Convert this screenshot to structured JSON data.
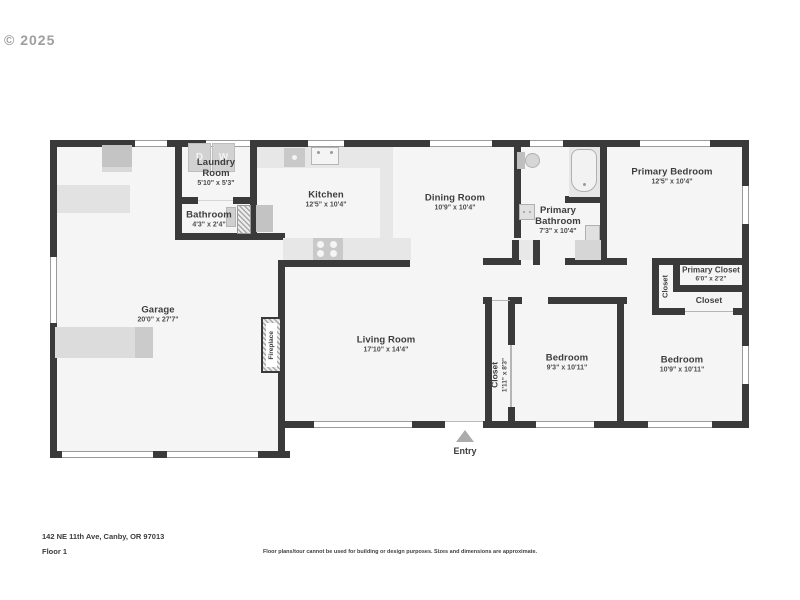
{
  "watermark": "© 2025",
  "footer": {
    "address": "142 NE 11th Ave, Canby, OR 97013",
    "floor": "Floor 1",
    "disclaimer": "Floor plans/tour cannot be used for building or design purposes. Sizes and dimensions are approximate."
  },
  "entry": {
    "label": "Entry"
  },
  "rooms": {
    "laundry": {
      "name": "Laundry Room",
      "dims": "5'10\" x 5'3\""
    },
    "bathroom": {
      "name": "Bathroom",
      "dims": "4'3\" x 2'4\""
    },
    "kitchen": {
      "name": "Kitchen",
      "dims": "12'5\" x 10'4\""
    },
    "dining": {
      "name": "Dining Room",
      "dims": "10'9\" x 10'4\""
    },
    "primary_bathroom": {
      "name": "Primary Bathroom",
      "dims": "7'3\" x 10'4\""
    },
    "primary_bedroom": {
      "name": "Primary Bedroom",
      "dims": "12'5\" x 10'4\""
    },
    "primary_closet": {
      "name": "Primary Closet",
      "dims": "6'0\" x 2'2\""
    },
    "closet_small": {
      "name": "Closet"
    },
    "closet_vertical": {
      "name": "Closet"
    },
    "garage": {
      "name": "Garage",
      "dims": "20'0\" x 27'7\""
    },
    "living": {
      "name": "Living Room",
      "dims": "17'10\" x 14'4\""
    },
    "hall_closet": {
      "name": "Closet",
      "dims": "1'11\" x 8'3\""
    },
    "bedroom1": {
      "name": "Bedroom",
      "dims": "9'3\" x 10'11\""
    },
    "bedroom2": {
      "name": "Bedroom",
      "dims": "10'9\" x 10'11\""
    },
    "fireplace": {
      "name": "Fireplace"
    }
  },
  "appliances": {
    "dryer_label": "D",
    "washer_label": "W"
  },
  "colors": {
    "wall": "#3a3a3a",
    "floor": "#f5f5f5",
    "window_line": "#9a9a9a",
    "text": "#3d3d3d"
  }
}
